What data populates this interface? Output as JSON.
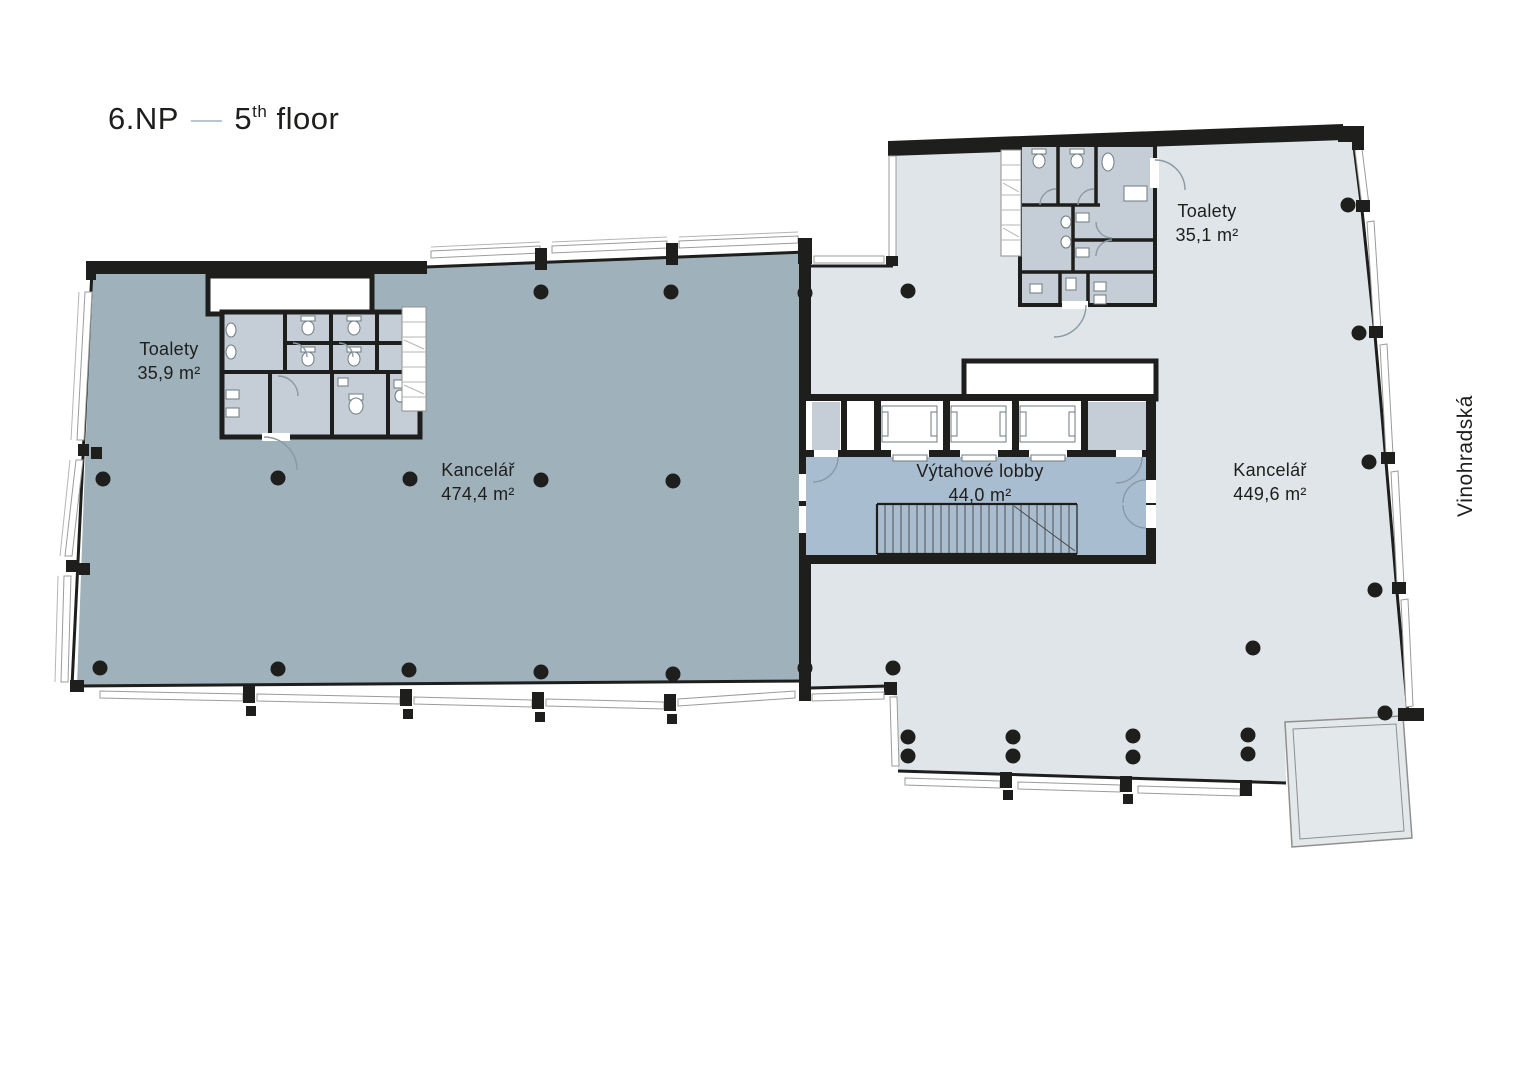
{
  "title": {
    "czech": "6.NP",
    "dash": "—",
    "number": "5",
    "suffix": "th",
    "word": "floor"
  },
  "street_label": "Vinohradská",
  "rooms": {
    "toilets_left": {
      "name": "Toalety",
      "area": "35,9 m²"
    },
    "office_left": {
      "name": "Kancelář",
      "area": "474,4 m²"
    },
    "lobby": {
      "name": "Výtahové lobby",
      "area": "44,0 m²"
    },
    "office_right": {
      "name": "Kancelář",
      "area": "449,6 m²"
    },
    "toilets_right": {
      "name": "Toalety",
      "area": "35,1 m²"
    }
  },
  "colors": {
    "wall": "#1E1E1C",
    "office_left": "#9FB1BB",
    "office_right": "#DFE5E8",
    "lobby": "#A9BDD1",
    "stall": "#C5CED6",
    "terrace": "#E3E8EB",
    "recess": "#FFFFFF",
    "window_stroke": "#9B9B99",
    "door_arc": "#8A99A3",
    "title_dash": "#B7C6D1",
    "text": "#1E1E1C"
  },
  "plan": {
    "column_radius": 7.5,
    "columns": [
      {
        "area": "office-left",
        "points": [
          [
            541,
            292
          ],
          [
            671,
            292
          ],
          [
            805,
            293
          ],
          [
            103,
            479
          ],
          [
            278,
            478
          ],
          [
            410,
            479
          ],
          [
            541,
            480
          ],
          [
            673,
            481
          ],
          [
            100,
            668
          ],
          [
            278,
            669
          ],
          [
            409,
            670
          ],
          [
            541,
            672
          ],
          [
            673,
            674
          ],
          [
            805,
            668
          ]
        ]
      },
      {
        "area": "office-right",
        "points": [
          [
            908,
            291
          ],
          [
            1348,
            205
          ],
          [
            1359,
            333
          ],
          [
            1369,
            462
          ],
          [
            1375,
            590
          ],
          [
            1253,
            648
          ],
          [
            893,
            668
          ],
          [
            908,
            737
          ],
          [
            908,
            756
          ],
          [
            1013,
            737
          ],
          [
            1013,
            756
          ],
          [
            1133,
            736
          ],
          [
            1133,
            757
          ],
          [
            1248,
            735
          ],
          [
            1248,
            754
          ],
          [
            1385,
            713
          ]
        ]
      }
    ]
  }
}
